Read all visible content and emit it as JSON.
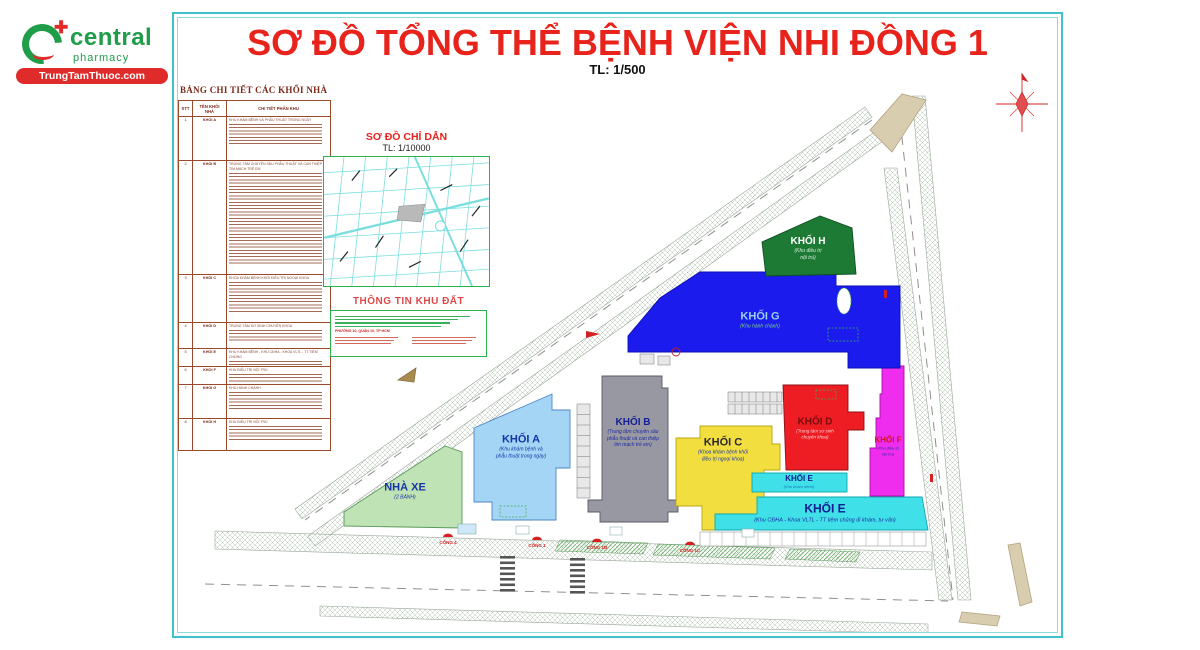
{
  "logo": {
    "brand": "central",
    "tagline": "pharmacy",
    "site": "TrungTamThuoc.com"
  },
  "title": {
    "main": "SƠ ĐỒ TỔNG THỂ BỆNH VIỆN NHI ĐỒNG 1",
    "scale": "TL: 1/500"
  },
  "legend_table": {
    "heading": "BẢNG CHI TIẾT CÁC KHỐI NHÀ",
    "columns": [
      "STT",
      "TÊN KHỐI NHÀ",
      "CHI TIẾT PHÂN KHU"
    ],
    "rows": [
      {
        "stt": "1",
        "name": "KHỐI A",
        "detail": "KHU KHÁM BỆNH VÀ PHẪU THUẬT TRONG NGÀY"
      },
      {
        "stt": "2",
        "name": "KHỐI B",
        "detail": "TRUNG TÂM CHUYÊN SÂU PHẪU THUẬT VÀ CAN THIỆP TIM MẠCH TRẺ EM"
      },
      {
        "stt": "3",
        "name": "KHỐI C",
        "detail": "KHOA KHÁM BỆNH KHỐI ĐIỀU TRỊ NGOẠI KHOA"
      },
      {
        "stt": "4",
        "name": "KHỐI D",
        "detail": "TRUNG TÂM SƠ SINH CHUYÊN KHOA"
      },
      {
        "stt": "5",
        "name": "KHỐI E",
        "detail": "KHU KHÁM BỆNH - KHU CĐHA - KHOA VLTL - TT TIÊM CHỦNG"
      },
      {
        "stt": "6",
        "name": "KHỐI F",
        "detail": "KHU ĐIỀU TRỊ NỘI TRÚ"
      },
      {
        "stt": "7",
        "name": "KHỐI G",
        "detail": "KHU HÀNH CHÁNH"
      },
      {
        "stt": "8",
        "name": "KHỐI H",
        "detail": "KHU ĐIỀU TRỊ NỘI TRÚ"
      }
    ]
  },
  "inset": {
    "heading": "SƠ ĐỒ CHỈ DẪN",
    "scale": "TL: 1/10000"
  },
  "site_info": {
    "heading": "THÔNG TIN KHU ĐẤT",
    "address": "PHƯỜNG 10, QUẬN 10, TP HCM"
  },
  "blocks": [
    {
      "label": "KHỐI A",
      "desc": "(Khu khám bệnh và\nphẫu thuật trong ngày)"
    },
    {
      "label": "KHỐI B",
      "desc": "(Trung tâm chuyên sâu\nphẫu thuật và can thiệp\ntim mạch trẻ em)"
    },
    {
      "label": "KHỐI C",
      "desc": "(Khoa khám bệnh khối\nđiều trị ngoại khoa)"
    },
    {
      "label": "KHỐI D",
      "desc": "(Trung tâm sơ sinh\nchuyên khoa)"
    },
    {
      "label": "KHỐI E",
      "desc": "(Khu khám bệnh)"
    },
    {
      "label": "KHỐI E",
      "desc": "(Khu CĐHA - Khoa VLTL - TT tiêm chủng đi khám, tư vấn)"
    },
    {
      "label": "KHỐI F",
      "desc": "(Khu điều trị\nnội trú)"
    },
    {
      "label": "KHỐI G",
      "desc": "(Khu hành chánh)"
    },
    {
      "label": "KHỐI H",
      "desc": "(Khu điều trị\nnội trú)"
    },
    {
      "label": "NHÀ XE",
      "desc": "(2 BÁNH)"
    }
  ],
  "gates": [
    {
      "label": "CỔNG 4"
    },
    {
      "label": "CỔNG 1"
    },
    {
      "label": "CỔNG 1B"
    },
    {
      "label": "CỔNG 1C"
    }
  ],
  "colors": {
    "frame": "#3fc3cb",
    "title": "#e8231b",
    "logo_green": "#1f9d49",
    "logo_red": "#e02b2b",
    "inset_green": "#2bb24c",
    "map_cyan": "#7adede",
    "gate_red": "#d42020",
    "block_a": "#a5d5f5",
    "block_b": "#9898a2",
    "block_c": "#f2de3e",
    "block_d": "#ee1c23",
    "block_e": "#3fe0e8",
    "block_f": "#ee2dee",
    "block_g": "#1b1bed",
    "block_h": "#1d7a35",
    "parking": "#bfe3b4"
  }
}
